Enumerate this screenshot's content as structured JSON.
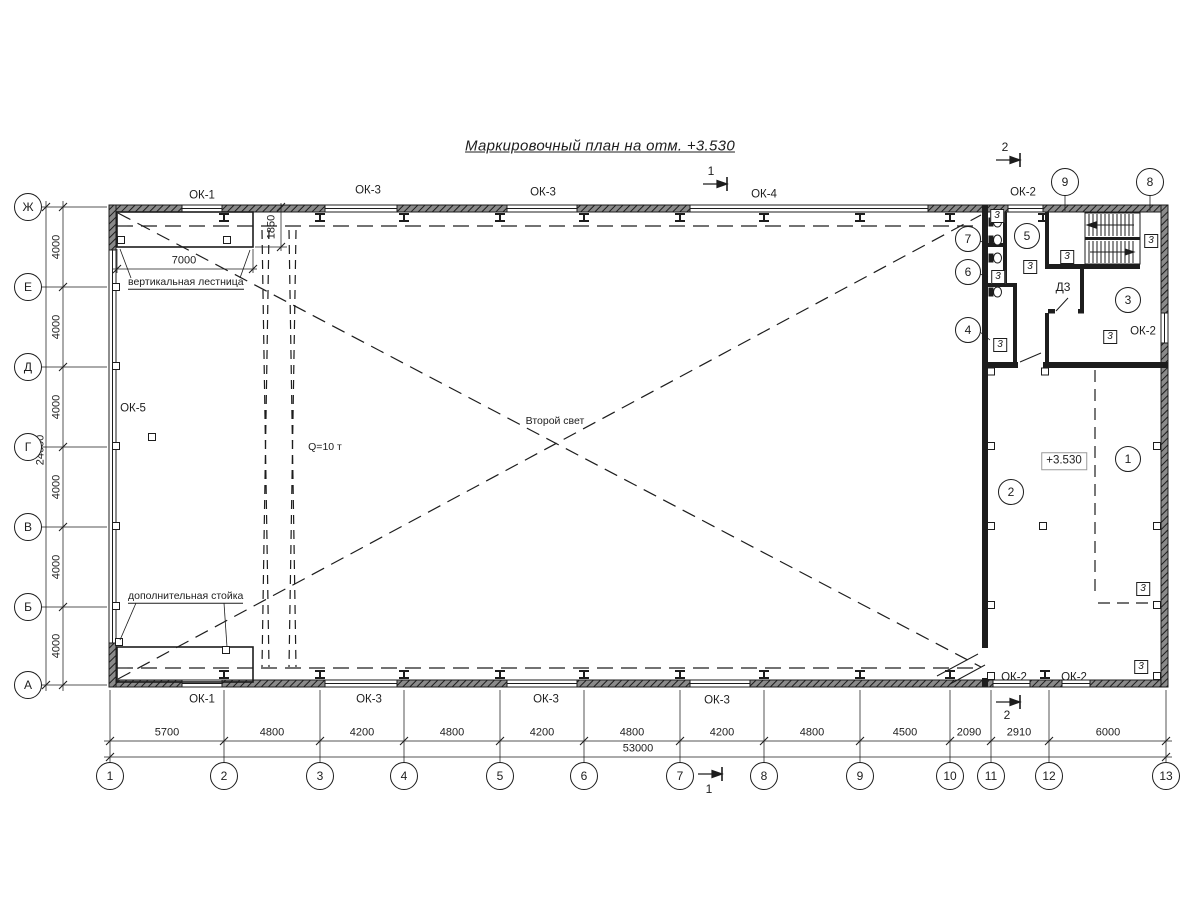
{
  "title": "Маркировочный план на отм. +3.530",
  "colors": {
    "line": "#1d1d1d",
    "hatch": "#8a8a8a",
    "bg": "#ffffff"
  },
  "axes": {
    "cols": [
      "1",
      "2",
      "3",
      "4",
      "5",
      "6",
      "7",
      "8",
      "9",
      "10",
      "11",
      "12",
      "13"
    ],
    "rows": [
      "Ж",
      "Е",
      "Д",
      "Г",
      "В",
      "Б",
      "А"
    ]
  },
  "dimensions": {
    "bottom_segments": [
      "5700",
      "4800",
      "4200",
      "4800",
      "4200",
      "4800",
      "4200",
      "4800",
      "4500",
      "2090",
      "2910",
      "6000"
    ],
    "bottom_total": "53000",
    "left_segments": [
      "4000",
      "4000",
      "4000",
      "4000",
      "4000",
      "4000"
    ],
    "left_total": "24000",
    "platform_width": "7000",
    "ladder_offset": "1850"
  },
  "windows": {
    "top": [
      "ОК-1",
      "ОК-3",
      "ОК-3",
      "ОК-4",
      "ОК-2"
    ],
    "bottom": [
      "ОК-1",
      "ОК-3",
      "ОК-3",
      "ОК-3",
      "ОК-2",
      "ОК-2"
    ],
    "left_wall": "ОК-5",
    "room3_wall": "ОК-2"
  },
  "annotations": {
    "vertical_ladder": "вертикальная лестница",
    "additional_post": "дополнительная стойка",
    "second_light": "Второй свет",
    "crane_capacity": "Q=10 т",
    "elevation_mark": "+3.530",
    "door_mark": "Д3"
  },
  "position_marks": {
    "rooms": [
      "1",
      "2",
      "3",
      "4",
      "5",
      "6",
      "7"
    ],
    "wall_top": [
      "9",
      "8"
    ]
  },
  "partition_marker": "3",
  "sections": {
    "section1": "1",
    "section2": "2"
  }
}
